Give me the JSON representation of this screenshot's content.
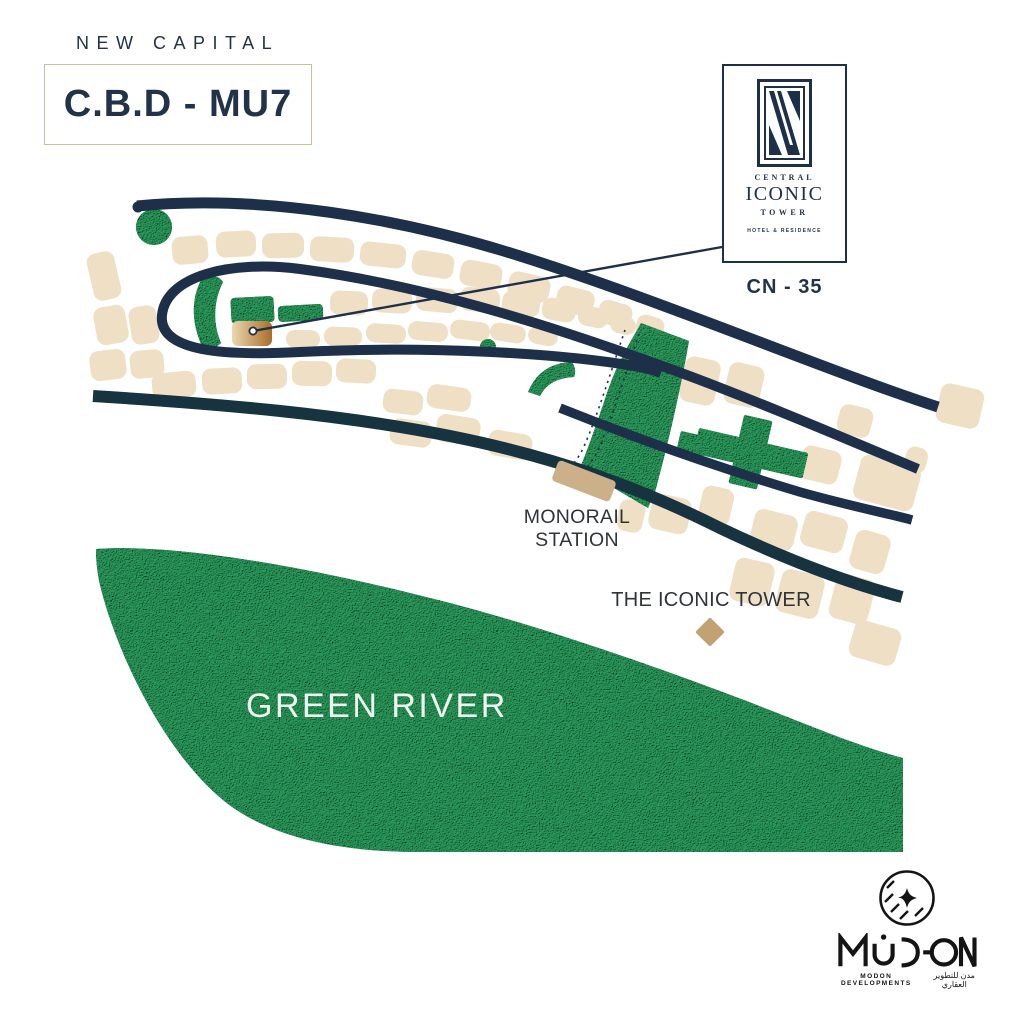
{
  "header": {
    "region": "NEW CAPITAL",
    "district": "C.B.D - MU7"
  },
  "tower_card": {
    "line1": "CENTRAL",
    "line2": "ICONIC",
    "line3": "TOWER",
    "line4": "HOTEL & RESIDENCE",
    "plot_code": "CN - 35"
  },
  "map_labels": {
    "monorail_line1": "MONORAIL",
    "monorail_line2": "STATION",
    "iconic_tower": "THE ICONIC TOWER",
    "green_river": "GREEN RIVER"
  },
  "developer": {
    "name": "MODON",
    "caption_en": "MODON DEVELOPMENTS",
    "caption_ar": "مدن للتطوير العقاري"
  },
  "theme": {
    "navy": "#1e3049",
    "roadTeal": "#17333f",
    "block": "#eedfc5",
    "green": "#177544",
    "station": "#cbb08a",
    "diamond": "#c2a173",
    "highlightFrom": "#ecd7ae",
    "highlightTo": "#a86d2b",
    "textDark": "#2f343a",
    "navyText": "#223349",
    "gold": "#cdbd9b",
    "ink": "#141414"
  }
}
